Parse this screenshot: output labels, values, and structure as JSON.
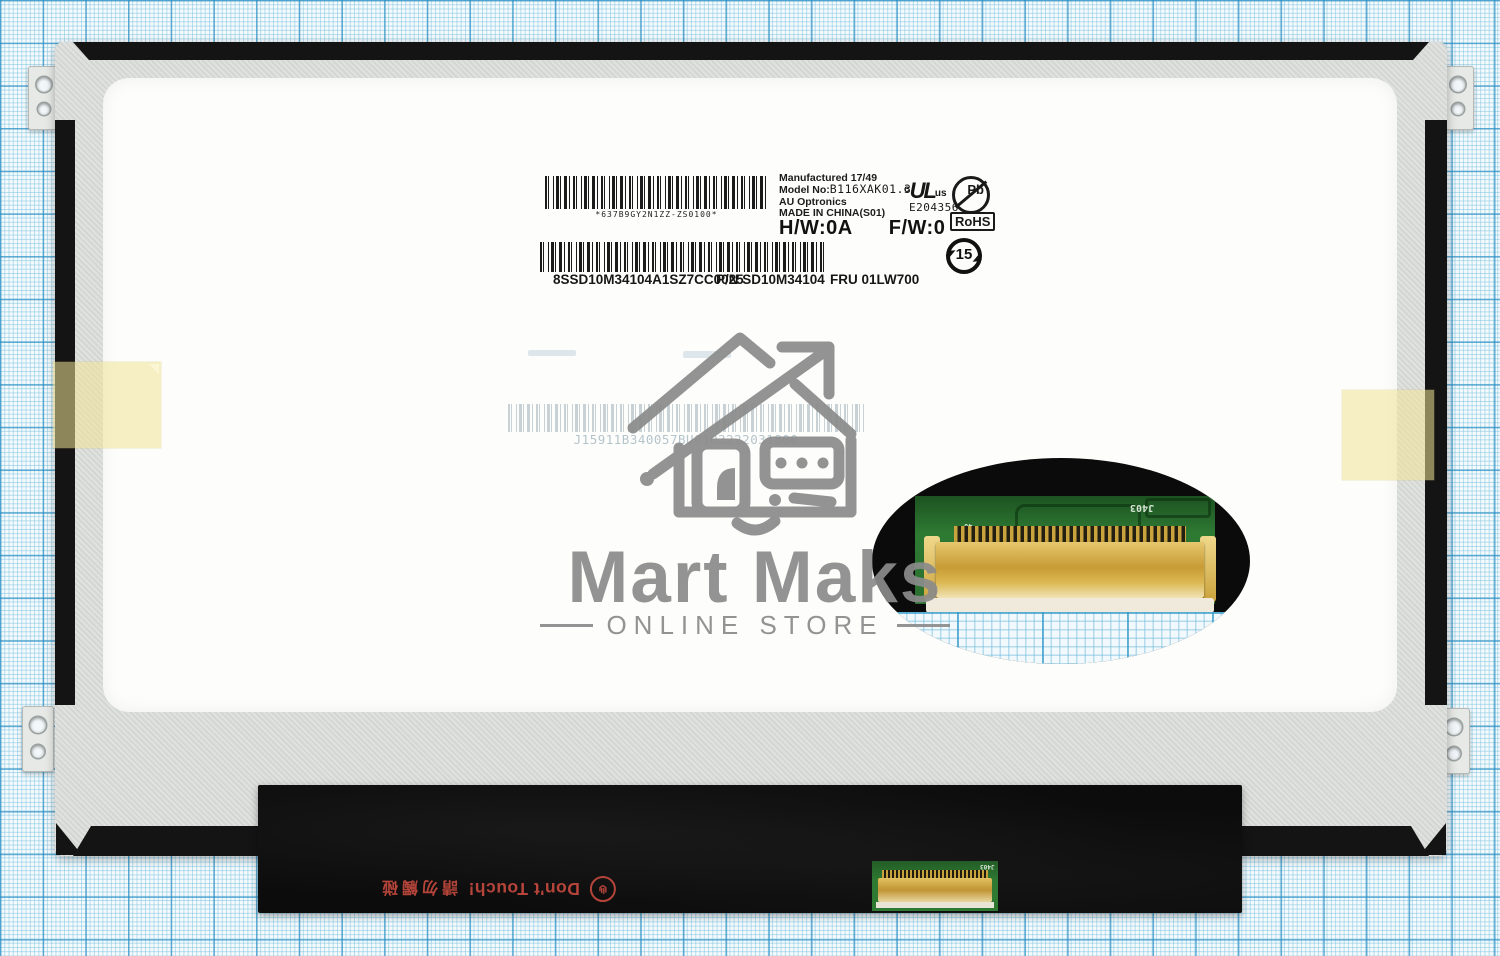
{
  "watermark": {
    "title": "Mart Maks",
    "subtitle": "ONLINE STORE"
  },
  "label": {
    "barcode1_caption": "*637B9GY2N1ZZ-ZS0100*",
    "manufactured": "Manufactured 17/49",
    "model_label": "Model No:",
    "model_value": "B116XAK01.3",
    "maker": "AU Optronics",
    "origin": "MADE IN CHINA(S01)",
    "hw": "H/W:0A",
    "fw": "F/W:0",
    "ul_prefix": "c",
    "ul_mark": "UL",
    "ul_suffix": "us",
    "ul_file": "E204356",
    "pb_symbol": "Pb",
    "rohs": "RoHS",
    "china_rohs_years": "15",
    "serial_caption": "8SSD10M34104A1SZ7CC0025",
    "pn_caption": "P/N SD10M34104",
    "fru_caption": "FRU 01LW700",
    "faint_code": "J15911B340057BU0103222031800"
  },
  "panel": {
    "warning_text": "Don't Touch!",
    "warning_text_cn": "請勿觸碰",
    "connector_silkscreen": "J403",
    "connector_pin_mark": "40",
    "pcb_reg_mark": "®"
  },
  "colors": {
    "paper": "#f5fafc",
    "grid_minor": "#7dc3e1",
    "grid_major": "#288cc3",
    "panel_black": "#141414",
    "metal_silver": "#d8dbd7",
    "mylar_white": "#fdfdfb",
    "pcb_green": "#2e7a33",
    "connector_gold": "#cfa83f",
    "warning_red": "#b5443a",
    "tape_yellow": "#f0e496",
    "watermark_gray": "#8b8b8b"
  }
}
